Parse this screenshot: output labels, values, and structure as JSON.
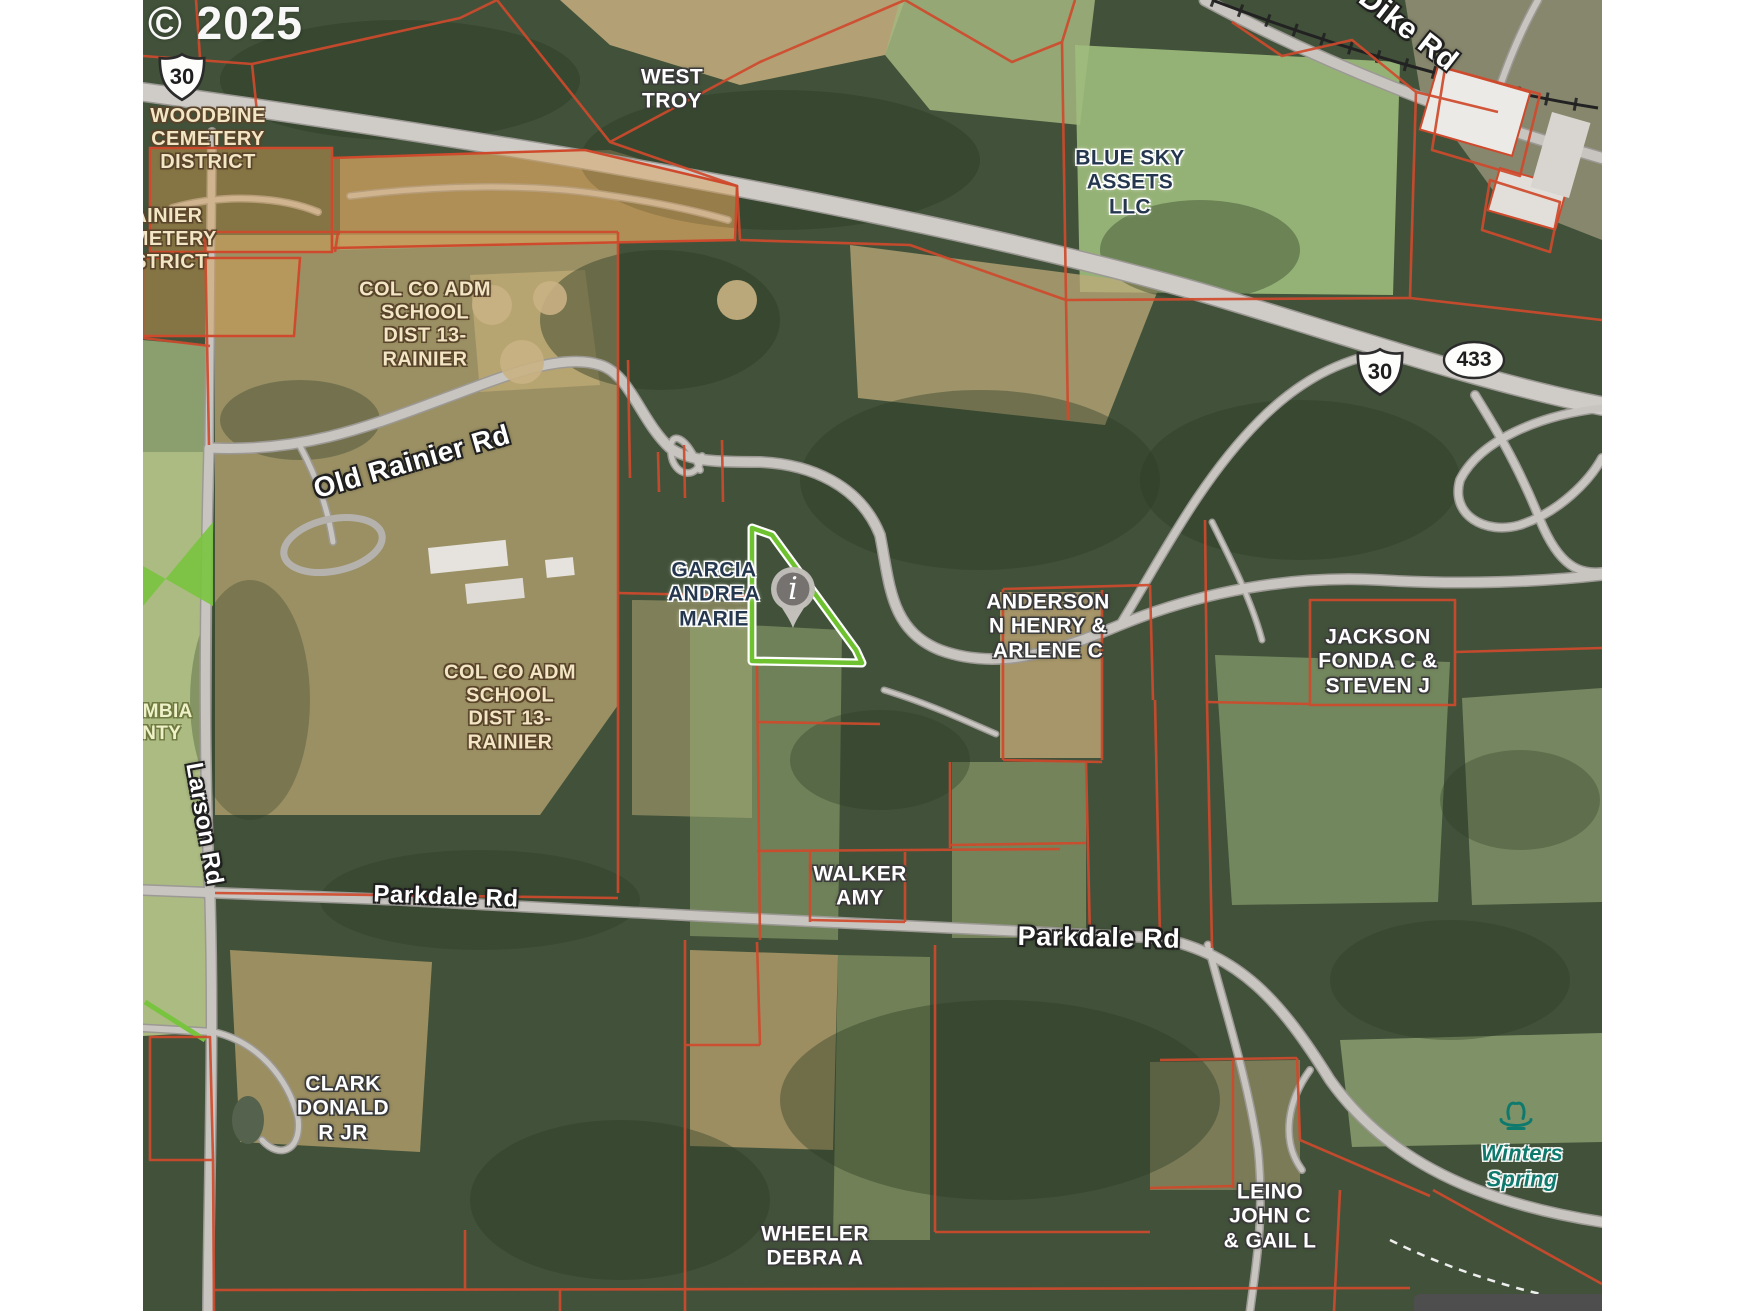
{
  "watermark": {
    "text": "© 2025"
  },
  "marker": {
    "type": "info-pin",
    "glyph": "i"
  },
  "shields": [
    {
      "id": "us-30-shield-west",
      "style": "us",
      "text": "30",
      "x": 182,
      "y": 77
    },
    {
      "id": "us-30-shield-east",
      "style": "us",
      "text": "30",
      "x": 1380,
      "y": 372
    },
    {
      "id": "or-433-shield",
      "style": "oval",
      "text": "433",
      "x": 1474,
      "y": 360
    }
  ],
  "road_labels": [
    {
      "text": "Dike Rd",
      "x": 1408,
      "y": 30,
      "rot": 38,
      "size": 30
    },
    {
      "text": "Old Rainier Rd",
      "x": 412,
      "y": 462,
      "rot": -16,
      "size": 28
    },
    {
      "text": "Larson Rd",
      "x": 204,
      "y": 824,
      "rot": 80,
      "size": 24
    },
    {
      "text": "Parkdale Rd",
      "x": 446,
      "y": 897,
      "rot": 2,
      "size": 24
    },
    {
      "text": "Parkdale Rd",
      "x": 1099,
      "y": 938,
      "rot": 1,
      "size": 27
    }
  ],
  "parcel_labels": [
    {
      "text": "WOODBINE\nCEMETERY\nDISTRICT",
      "x": 208,
      "y": 140,
      "style": "cream",
      "size": 20
    },
    {
      "text": "RAINIER\nCEMETERY\nDISTRICT",
      "x": 160,
      "y": 240,
      "style": "cream",
      "size": 20
    },
    {
      "text": "COL CO ADM\nSCHOOL\nDIST 13-\nRAINIER",
      "x": 425,
      "y": 325,
      "style": "cream",
      "size": 20
    },
    {
      "text": "COL CO ADM\nSCHOOL\nDIST 13-\nRAINIER",
      "x": 510,
      "y": 708,
      "style": "cream",
      "size": 20
    },
    {
      "text": "COLUMBIA\nCOUNTY",
      "x": 140,
      "y": 723,
      "style": "county",
      "size": 19
    },
    {
      "text": "WEST\nTROY",
      "x": 672,
      "y": 90,
      "style": "white",
      "size": 21
    },
    {
      "text": "BLUE SKY\nASSETS\nLLC",
      "x": 1130,
      "y": 183,
      "style": "navy",
      "size": 21
    },
    {
      "text": "GARCIA\nANDREA\nMARIE",
      "x": 714,
      "y": 595,
      "style": "navy",
      "size": 21
    },
    {
      "text": "ANDERSON\nN HENRY &\nARLENE C",
      "x": 1048,
      "y": 627,
      "style": "white",
      "size": 21
    },
    {
      "text": "JACKSON\nFONDA C &\nSTEVEN J",
      "x": 1378,
      "y": 662,
      "style": "white",
      "size": 21
    },
    {
      "text": "WALKER\nAMY",
      "x": 860,
      "y": 887,
      "style": "white",
      "size": 21
    },
    {
      "text": "CLARK\nDONALD\nR JR",
      "x": 343,
      "y": 1109,
      "style": "white",
      "size": 21
    },
    {
      "text": "WHEELER\nDEBRA A",
      "x": 815,
      "y": 1247,
      "style": "white",
      "size": 21
    },
    {
      "text": "LEINO\nJOHN C\n& GAIL L",
      "x": 1270,
      "y": 1217,
      "style": "white",
      "size": 21
    }
  ],
  "poi_labels": [
    {
      "text": "Winters\nSpring",
      "x": 1522,
      "y": 1166,
      "style": "teal",
      "size": 22,
      "icon": "spring-icon",
      "icon_x": 1516,
      "icon_y": 1118
    }
  ],
  "colors": {
    "parcel_line": "#cf4a2c",
    "highlight_green": "#6fc22f",
    "owner_label_navy": "#25374e",
    "cemetery_overlay": "rgba(214,160,82,0.45)",
    "county_strip_green": "#79c43f",
    "spring_teal": "#0e7a6e",
    "road_fill": "#c8c5c1",
    "road_casing": "#9c9995",
    "railroad": "#222222",
    "marker_gray": "#757270"
  }
}
